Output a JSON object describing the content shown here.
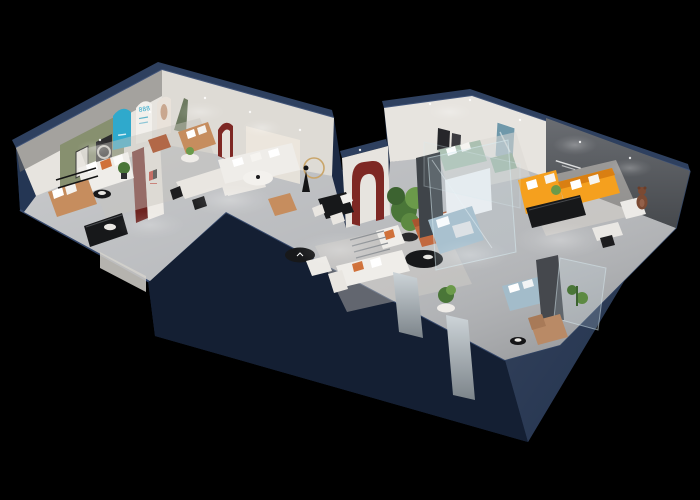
{
  "canvas": {
    "width": 700,
    "height": 500,
    "background": "#000000"
  },
  "palette": {
    "wall_face": "#1c2a44",
    "wall_face_dark": "#141f33",
    "wall_face_light": "#243654",
    "wall_top": "#2e405f",
    "wall_edge": "#43567a",
    "floor": "#b4b6b9",
    "rug": "#d7d3cc",
    "interior_white": "#e7e4df",
    "green_wall": "#87906f",
    "door_green": "#6d7a60",
    "cyan": "#2fa9cc",
    "red": "#7e2824",
    "orange": "#f5a01e",
    "terracotta": "#c2693f",
    "sage": "#abc0b1",
    "white_sofa": "#efede9",
    "caramel": "#c68d5e",
    "blue_bed": "#a3bcca",
    "tan": "#b98a66",
    "feature_wall": "#56595d",
    "black_furniture": "#17181a",
    "plant": "#4a7638",
    "plant_light": "#6b9a4a",
    "copper": "#b26847",
    "bear": "#7b4a33",
    "glass": "#cfe3ea",
    "gold": "#c9a56a",
    "mirror": "#aab2b7"
  },
  "texts": {
    "arch_poster_number": "888"
  },
  "scene": {
    "description_objects": [
      "green-accent-wall",
      "arched-poster-wall",
      "cyan-arch-panel",
      "red-arch-portal",
      "white-sectional-sofa",
      "dining-set",
      "mannequin-display",
      "orange-sectional-sofa",
      "feature-wall",
      "sage-sofa-set",
      "glass-bedroom-display",
      "terracotta-sofa",
      "potted-tree",
      "teddy-bear-figure",
      "blue-bed",
      "tan-chaise",
      "media-consoles"
    ]
  }
}
